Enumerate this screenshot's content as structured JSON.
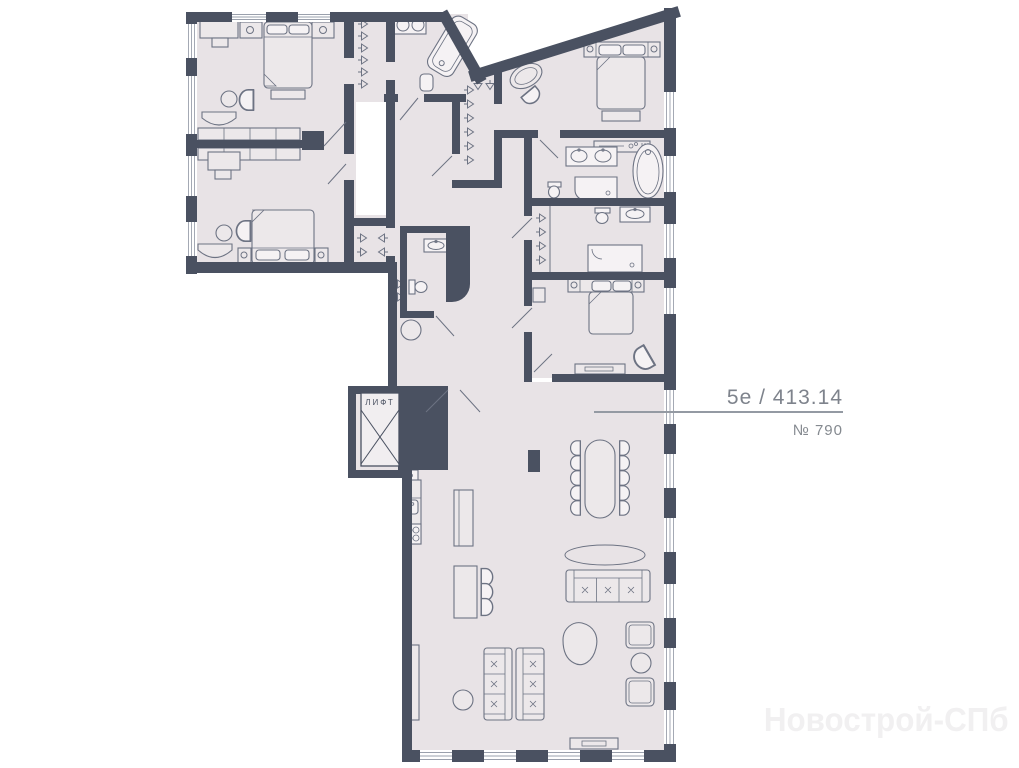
{
  "labels": {
    "unit": "5e / 413.14",
    "number": "№ 790",
    "elevator": "ЛИФТ",
    "watermark": "Новострой-СПб"
  },
  "colors": {
    "background": "#ffffff",
    "wall": "#4a5161",
    "floor": "#e8e3e6",
    "furniture_stroke": "#6d7383",
    "fixture_fill": "#f5f2f4",
    "label_text": "#7e838c",
    "leader_line": "#949aa3",
    "watermark_text": "#f1f0f1"
  }
}
